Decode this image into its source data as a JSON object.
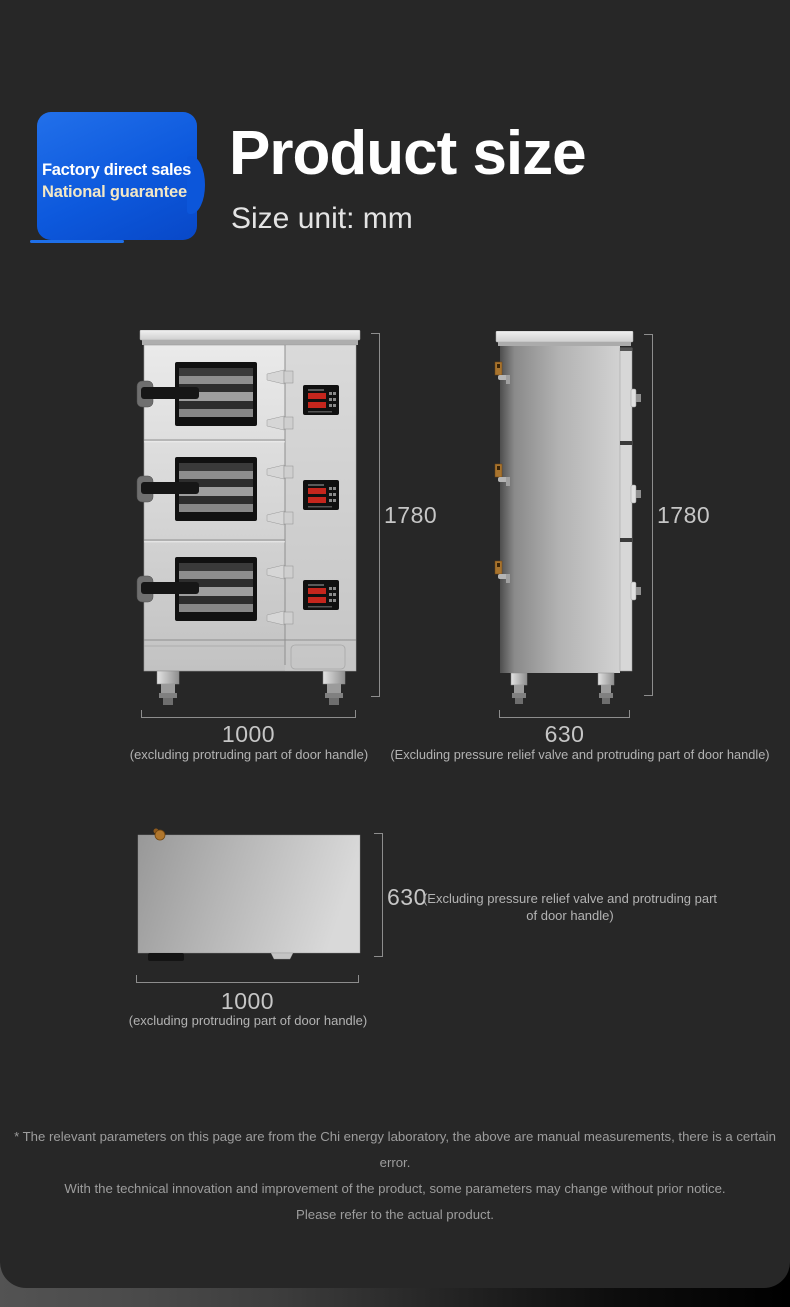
{
  "colors": {
    "page_background": "#272727",
    "badge_blue": "#0d59dd",
    "badge_secondary_text": "#f3e8c6",
    "dimension_text": "#c6c6c6",
    "caption_text": "#b3b3b3",
    "disclaimer_text": "#9d9d9d",
    "display_red": "#c5261d"
  },
  "header": {
    "badge_line1": "Factory direct sales",
    "badge_line2": "National guarantee",
    "title": "Product size",
    "subtitle": "Size unit: mm"
  },
  "figures": {
    "front": {
      "height": "1780",
      "width": "1000",
      "width_caption": "(excluding protruding part of door handle)"
    },
    "side": {
      "height": "1780",
      "depth": "630",
      "depth_caption": "(Excluding pressure relief valve and protruding part of door handle)"
    },
    "top": {
      "depth": "630",
      "depth_caption": "(Excluding pressure relief valve and protruding part of door handle)",
      "width": "1000",
      "width_caption": "(excluding protruding part of door handle)"
    }
  },
  "disclaimer": {
    "line1": "* The relevant parameters on this page are from the Chi energy laboratory, the above are manual measurements, there is a certain error.",
    "line2": "With the technical innovation and improvement of the product, some parameters may change without prior notice.",
    "line3": "Please refer to the actual product."
  }
}
